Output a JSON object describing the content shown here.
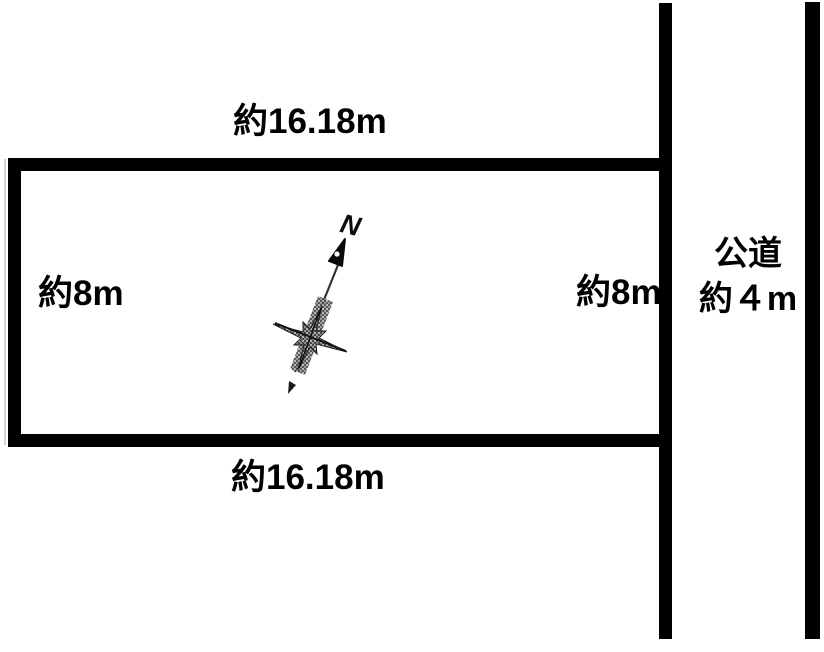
{
  "parcel": {
    "top_dimension": "約16.18m",
    "bottom_dimension": "約16.18m",
    "left_dimension": "約8m",
    "right_dimension": "約8m"
  },
  "road": {
    "name": "公道",
    "width_label": "約４m"
  },
  "compass": {
    "north_label": "N"
  },
  "colors": {
    "outline": "#000000",
    "background": "#ffffff",
    "compass_fill": "#474747"
  }
}
